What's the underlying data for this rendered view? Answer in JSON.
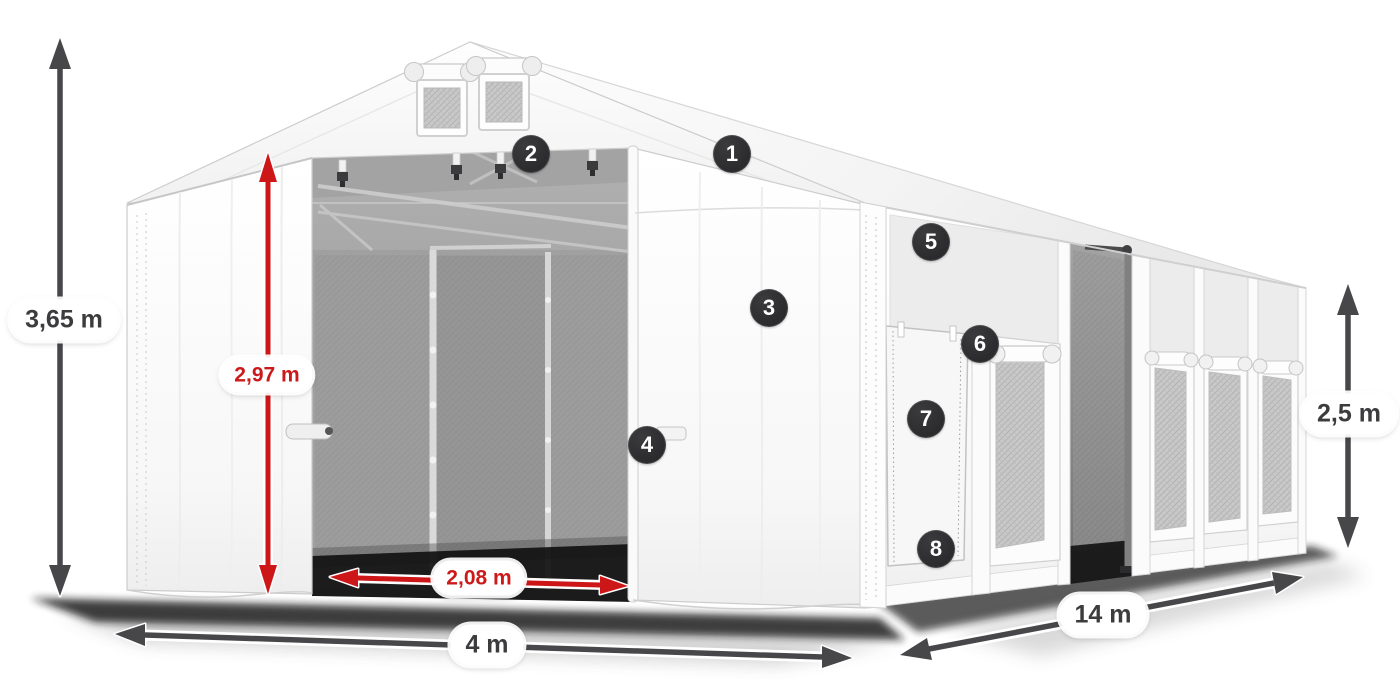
{
  "page": {
    "description": "Isometric product diagram of a white PVC storage tent with dimension annotations and numbered feature callouts"
  },
  "dimension_labels": {
    "total_height": "3,65 m",
    "entrance_height": "2,97 m",
    "entrance_width": "2,08 m",
    "front_width": "4 m",
    "side_length": "14 m",
    "side_wall_height": "2,5 m"
  },
  "callouts": [
    {
      "number": "1"
    },
    {
      "number": "2"
    },
    {
      "number": "3"
    },
    {
      "number": "4"
    },
    {
      "number": "5"
    },
    {
      "number": "6"
    },
    {
      "number": "7"
    },
    {
      "number": "8"
    }
  ],
  "colors": {
    "dimension_arrow_gray": "#47474a",
    "dimension_arrow_red": "#cd1618",
    "label_pill_background": "#ffffff",
    "label_text_dark": "#3c3c3e",
    "label_text_red": "#cc1a1a",
    "callout_background": "#2d2d2f",
    "callout_text": "#ffffff",
    "tent_fabric": "#ffffff",
    "interior_shade": "#9b9b9b"
  }
}
